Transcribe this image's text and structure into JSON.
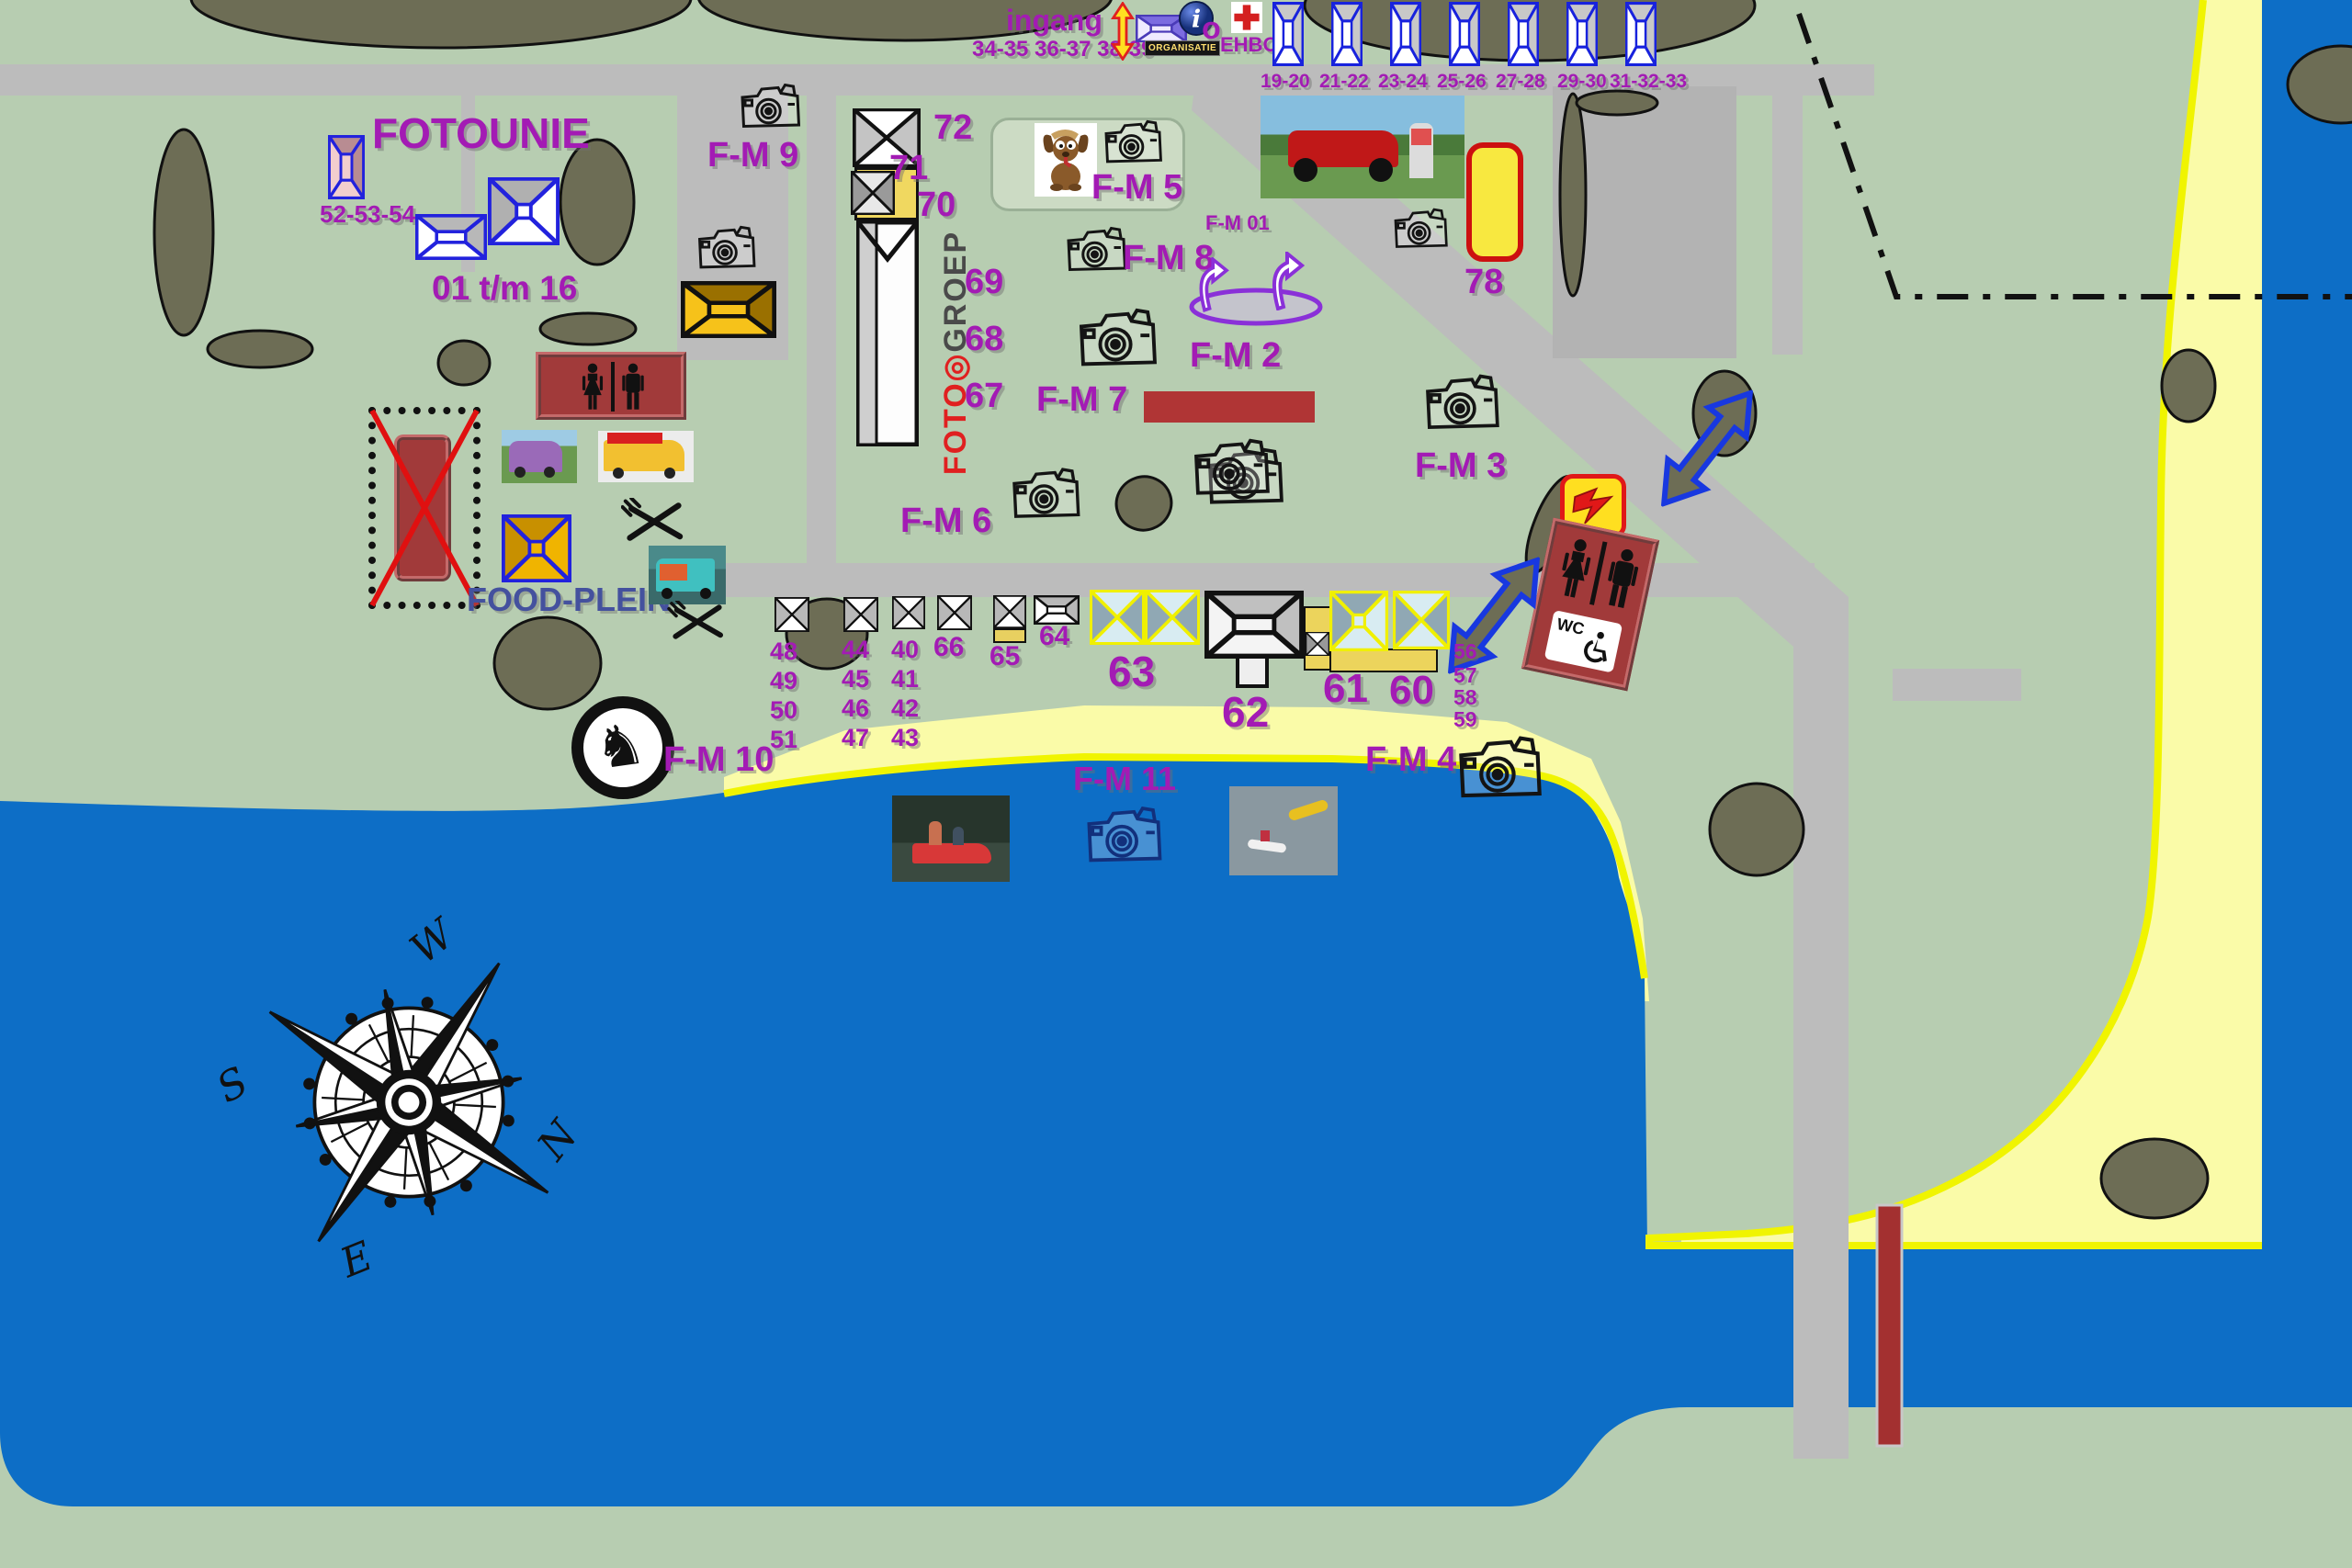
{
  "entrance": {
    "label": "ingang",
    "stands": "34-35 36-37 38-39",
    "organisatie": "ORGANISATIE",
    "info": "o",
    "ehbo": "EHBO"
  },
  "top_stands": [
    "19-20",
    "21-22",
    "23-24",
    "25-26",
    "27-28",
    "29-30",
    "31-32-33"
  ],
  "fotounie": {
    "title": "FOTOUNIE",
    "left_stands": "52-53-54",
    "range": "01 t/m 16"
  },
  "marquee": {
    "n72": "72",
    "n71": "71",
    "n70": "70",
    "logo_foto": "FOTO",
    "logo_groep": "GROEP"
  },
  "numbers": {
    "n69": "69",
    "n68": "68",
    "n67": "67",
    "n78": "78",
    "n66": "66",
    "n65": "65",
    "n64": "64",
    "n63": "63",
    "n62": "62",
    "n61": "61",
    "n60": "60"
  },
  "columns": {
    "c48": [
      "48",
      "49",
      "50",
      "51"
    ],
    "c44": [
      "44",
      "45",
      "46",
      "47"
    ],
    "c40": [
      "40",
      "41",
      "42",
      "43"
    ],
    "c56": [
      "56",
      "57",
      "58",
      "59"
    ]
  },
  "fm": {
    "fm01": "F-M 01",
    "fm2": "F-M 2",
    "fm3": "F-M 3",
    "fm4": "F-M 4",
    "fm5": "F-M 5",
    "fm6": "F-M 6",
    "fm7": "F-M 7",
    "fm8": "F-M 8",
    "fm9": "F-M 9",
    "fm10": "F-M 10",
    "fm11": "F-M 11"
  },
  "food": {
    "label": "FOOD-PLEIN"
  },
  "wc": {
    "label": "WC"
  },
  "compass": {
    "n": "N",
    "e": "E",
    "s": "S",
    "w": "W"
  },
  "colors": {
    "field": "#b7cdb1",
    "road": "#bcbcbc",
    "water": "#0d6ec6",
    "beach": "#fafba8",
    "beach_edge": "#f0f400",
    "tree": "#6d6d55",
    "label_purple": "#a31bb4",
    "dark_red": "#a13a3a",
    "bar_red": "#b03535",
    "tent_blue": "#1822dd",
    "tent_yellow": "#f0f000",
    "gold": "#f2b705",
    "food_text": "#44519e",
    "ehbo_red": "#d42020"
  }
}
